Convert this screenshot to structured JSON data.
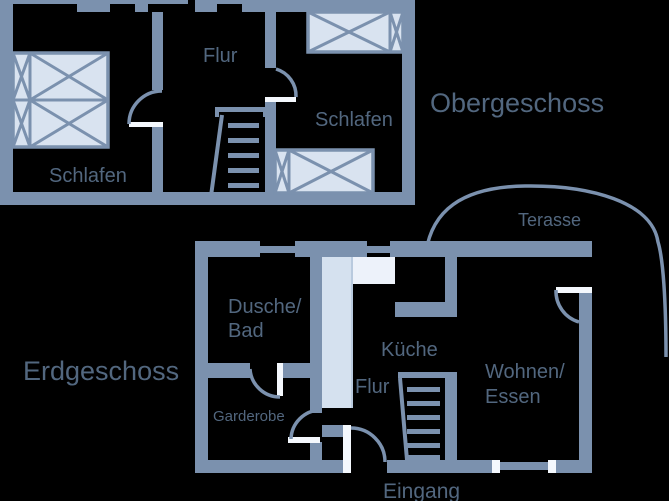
{
  "diagram_type": "floor-plan",
  "colors": {
    "background": "#000000",
    "wall": "#7b91ae",
    "furniture_fill": "#d9e3f0",
    "door_leaf": "#f4f8fd",
    "shaft_fill": "#d5e1ef",
    "shaft_highlight": "#edf2fa",
    "label_text": "#52677f"
  },
  "floors": {
    "obergeschoss": {
      "title": "Obergeschoss",
      "rooms": {
        "flur": {
          "label": "Flur"
        },
        "schlafen_left": {
          "label": "Schlafen"
        },
        "schlafen_right": {
          "label": "Schlafen"
        }
      }
    },
    "erdgeschoss": {
      "title": "Erdgeschoss",
      "rooms": {
        "dusche_bad": {
          "label_line1": "Dusche/",
          "label_line2": "Bad"
        },
        "garderobe": {
          "label": "Garderobe"
        },
        "kueche": {
          "label": "Küche"
        },
        "flur": {
          "label": "Flur"
        },
        "wohnen_essen": {
          "label_line1": "Wohnen/",
          "label_line2": "Essen"
        },
        "eingang": {
          "label": "Eingang"
        },
        "terasse": {
          "label": "Terasse"
        }
      }
    }
  }
}
